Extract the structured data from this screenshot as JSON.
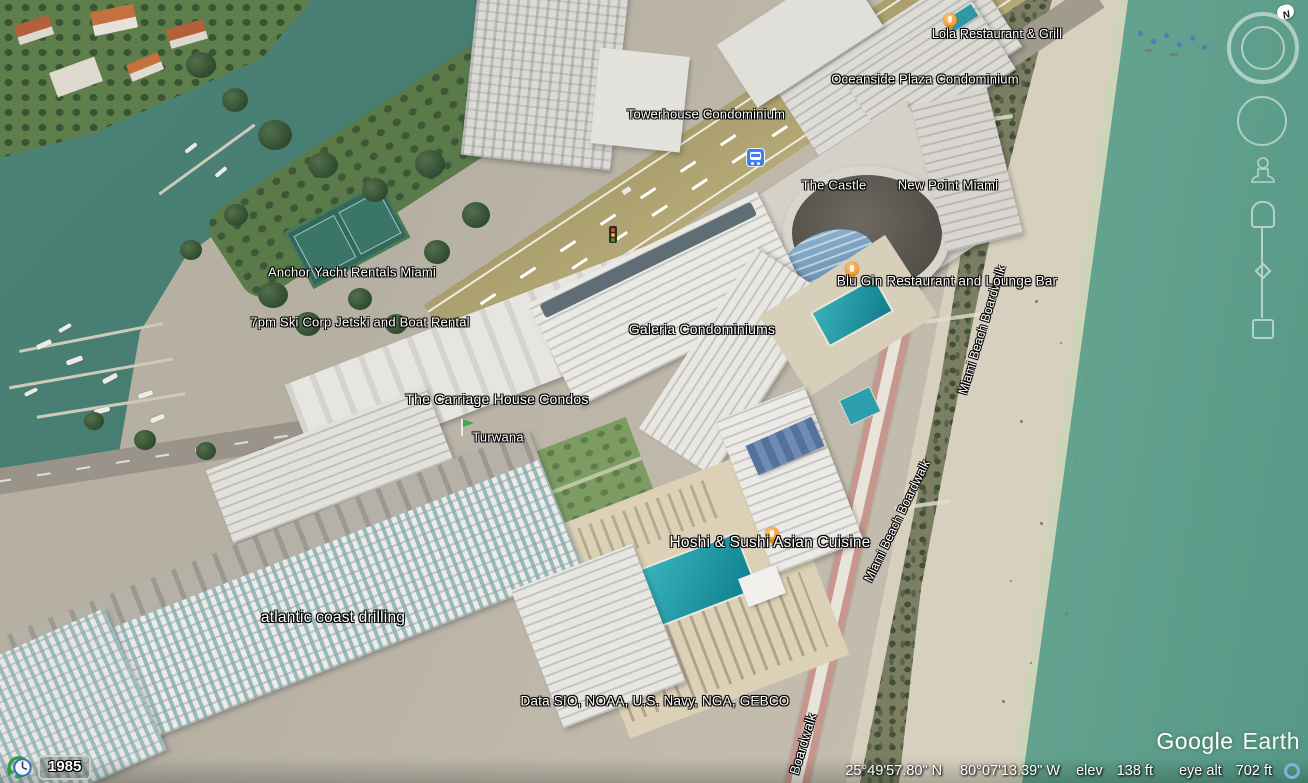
{
  "app": {
    "name": "Google Earth"
  },
  "watermark": {
    "brand": "Google",
    "product": "Earth"
  },
  "attribution": "Data SIO, NOAA, U.S. Navy, NGA, GEBCO",
  "time_control": {
    "year": "1985"
  },
  "compass": {
    "north": "N"
  },
  "status_bar": {
    "lat": "25°49'57.80\" N",
    "lon": "80°07'13.39\" W",
    "elev_label": "elev",
    "elev_value": "138 ft",
    "eye_label": "eye alt",
    "eye_value": "702 ft"
  },
  "places": {
    "lola": "Lola Restaurant & Grill",
    "oceanside": "Oceanside Plaza Condominium",
    "towerhouse": "Towerhouse Condominium",
    "castle": "The Castle",
    "new_point": "New Point Miami",
    "anchor_yacht": "Anchor Yacht Rentals Miami",
    "ski_corp": "7pm Ski Corp Jetski and Boat Rental",
    "galeria": "Galeria Condominiums",
    "blu_gin": "Blu Gin Restaurant and Lounge Bar",
    "carriage_house": "The Carriage House Condos",
    "turwana": "Turwana",
    "hoshi": "Hoshi & Sushi Asian Cuisine",
    "atlantic": "atlantic coast drilling"
  },
  "streets": {
    "boardwalk_upper": "Miami Beach Boardwalk",
    "boardwalk_mid": "Miami Beach Boardwalk",
    "boardwalk_lower": "Boardwalk"
  },
  "colors": {
    "intracoastal_water": "#47array7d71",
    "ocean": "#64a392",
    "sand": "#ded6c5",
    "pin_orange": "#f6a13b",
    "bus_blue": "#3d7ef0",
    "pool_teal": "#1d93a1"
  }
}
